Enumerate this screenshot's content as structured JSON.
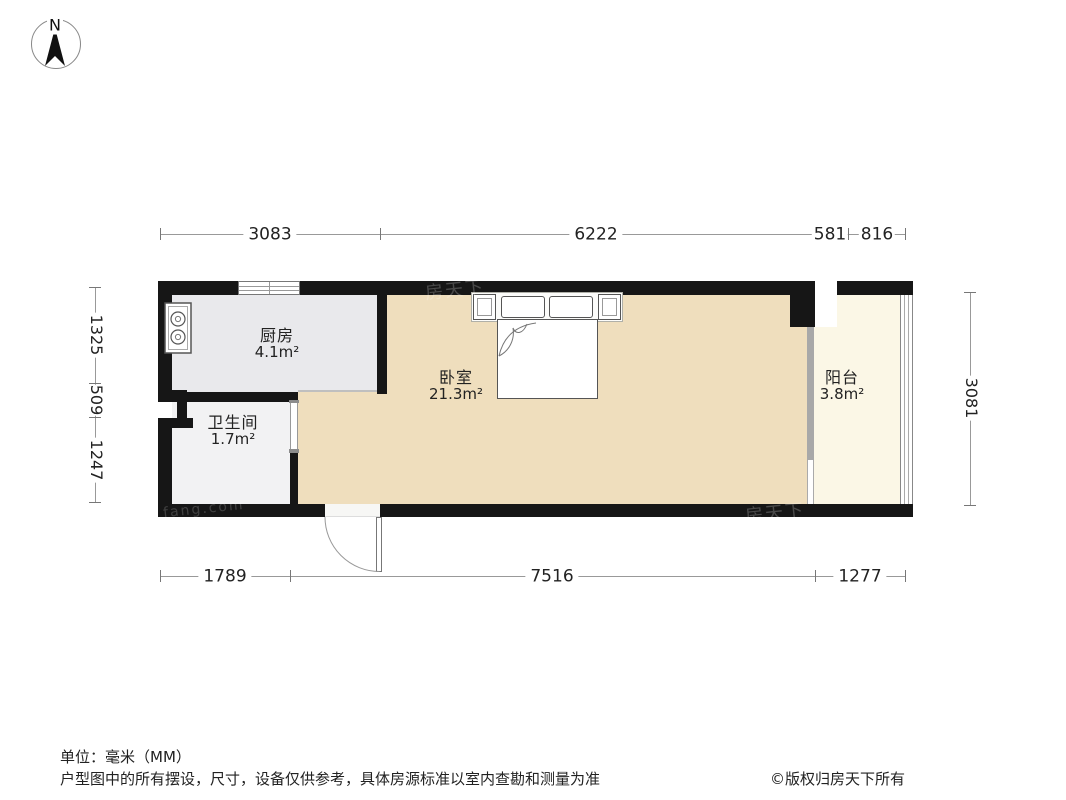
{
  "compass": {
    "north_label": "N"
  },
  "dimensions": {
    "top": [
      "3083",
      "6222",
      "581",
      "816"
    ],
    "bottom": [
      "1789",
      "7516",
      "1277"
    ],
    "left": [
      "1325",
      "509",
      "1247"
    ],
    "right": [
      "3081"
    ]
  },
  "rooms": [
    {
      "name": "厨房",
      "area": "4.1m²"
    },
    {
      "name": "卫生间",
      "area": "1.7m²"
    },
    {
      "name": "卧室",
      "area": "21.3m²"
    },
    {
      "name": "阳台",
      "area": "3.8m²"
    }
  ],
  "watermarks": {
    "brand": "房天下",
    "domain": "fang.com"
  },
  "footer": {
    "unit_note": "单位：毫米（MM）",
    "disclaimer": "户型图中的所有摆设，尺寸，设备仅供参考，具体房源标准以室内查勘和测量为准",
    "copyright": "©版权归房天下所有"
  },
  "colors": {
    "wall": "#161616",
    "kitchen_floor": "#e9e9ec",
    "bathroom_floor": "#f2f2f3",
    "bedroom_floor": "#efdebd",
    "balcony_floor": "#fbf7e6",
    "dimension_line": "#999999"
  }
}
